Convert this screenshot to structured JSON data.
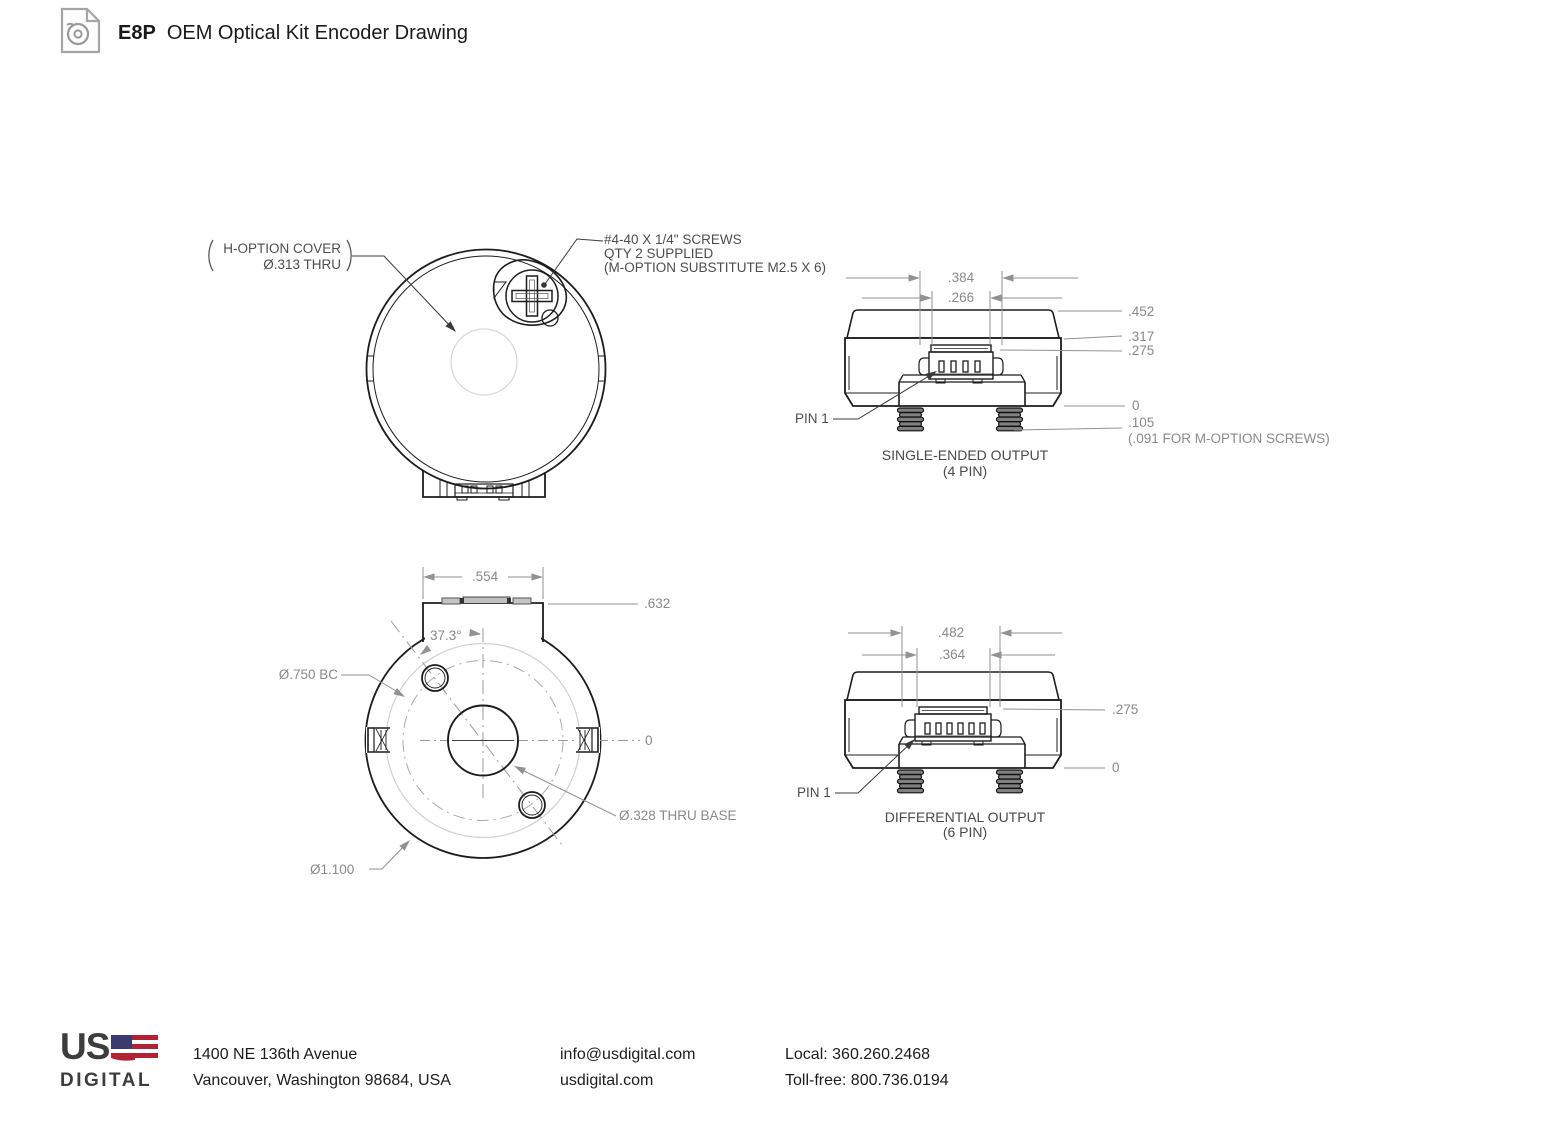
{
  "header": {
    "product": "E8P",
    "title": "OEM Optical Kit Encoder Drawing"
  },
  "front_view": {
    "cover_label": [
      "H-OPTION COVER",
      "Ø.313 THRU"
    ],
    "screw_note": [
      "#4-40 X 1/4\" SCREWS",
      "QTY 2 SUPPLIED",
      "(M-OPTION SUBSTITUTE M2.5 X 6)"
    ]
  },
  "single_ended_view": {
    "dim_384": ".384",
    "dim_266": ".266",
    "dim_452": ".452",
    "dim_317": ".317",
    "dim_275": ".275",
    "dim_0": "0",
    "dim_105": ".105",
    "dim_105_note": "(.091 FOR M-OPTION SCREWS)",
    "pin1": "PIN 1",
    "caption": [
      "SINGLE-ENDED OUTPUT",
      "(4 PIN)"
    ]
  },
  "bottom_view": {
    "dim_554": ".554",
    "dim_632": ".632",
    "angle": "37.3°",
    "bolt_circle": "Ø.750 BC",
    "dim_0": "0",
    "center_hole": "Ø.328 THRU BASE",
    "outer_dia": "Ø1.100"
  },
  "differential_view": {
    "dim_482": ".482",
    "dim_364": ".364",
    "dim_275": ".275",
    "dim_0": "0",
    "pin1": "PIN 1",
    "caption": [
      "DIFFERENTIAL OUTPUT",
      "(6 PIN)"
    ]
  },
  "footer": {
    "logo": [
      "US",
      "DIGITAL"
    ],
    "address": [
      "1400 NE 136th Avenue",
      "Vancouver, Washington 98684, USA"
    ],
    "contact": [
      "info@usdigital.com",
      "usdigital.com"
    ],
    "phones": [
      "Local: 360.260.2468",
      "Toll-free: 800.736.0194"
    ]
  },
  "colors": {
    "part_line": "#1c1c1c",
    "dim_line": "#929292",
    "dim_text": "#8a8a8a",
    "label_text": "#4d4d4d",
    "flag_red": "#B22234",
    "flag_blue": "#3C3B6E"
  }
}
